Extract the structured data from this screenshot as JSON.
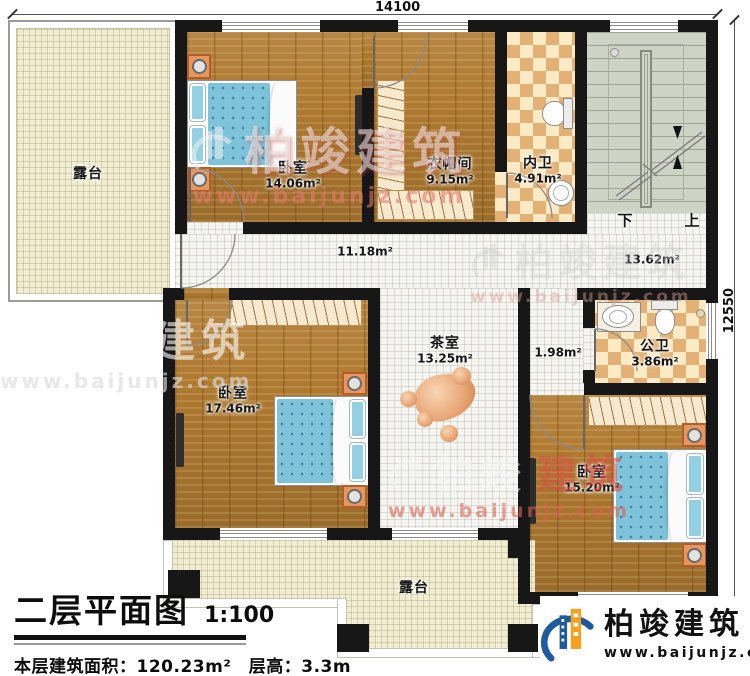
{
  "dimensions": {
    "top": "14100",
    "right": "12550"
  },
  "rooms": {
    "terrace_top": {
      "name": "露台"
    },
    "bedroom1": {
      "name": "卧室",
      "area": "14.06m²"
    },
    "cloakroom": {
      "name": "衣帽间",
      "area": "9.15m²"
    },
    "inner_bath": {
      "name": "内卫",
      "area": "4.91m²"
    },
    "stair_hall": {
      "area": "13.62m²"
    },
    "corridor": {
      "area": "11.18m²"
    },
    "bedroom2": {
      "name": "卧室",
      "area": "17.46m²"
    },
    "tea_room": {
      "name": "茶室",
      "area": "13.25m²"
    },
    "vestibule": {
      "area": "1.98m²"
    },
    "public_bath": {
      "name": "公卫",
      "area": "3.86m²"
    },
    "bedroom3": {
      "name": "卧室",
      "area": "15.20m²"
    },
    "terrace_bottom": {
      "name": "露台"
    }
  },
  "stairs": {
    "down": "下",
    "up": "上"
  },
  "title_block": {
    "title": "二层平面图",
    "scale": "1:100",
    "info": "本层建筑面积：120.23m²　层高：3.3m"
  },
  "brand": {
    "name": "柏竣建筑",
    "url": "www.baijunjz.com"
  },
  "watermark": {
    "name": "柏竣建筑",
    "name_a": "柏竣",
    "name_b": "建筑",
    "url": "www.baijunjz.com"
  },
  "colors": {
    "wall": "#171717",
    "wood": "#af7a31",
    "terrace": "#f1edd5",
    "tile": "#f5f5f1",
    "checker_light": "#fbeac3",
    "checker_dark": "#e3b075",
    "stairs": "#cdd3c5",
    "bed_blue": "#7fc3da",
    "nightstand": "#e5975d",
    "stone": "#eaa878",
    "brand_blue": "#1e5aa0",
    "brand_orange": "#f6a01e",
    "watermark_red": "#d65a4c"
  }
}
